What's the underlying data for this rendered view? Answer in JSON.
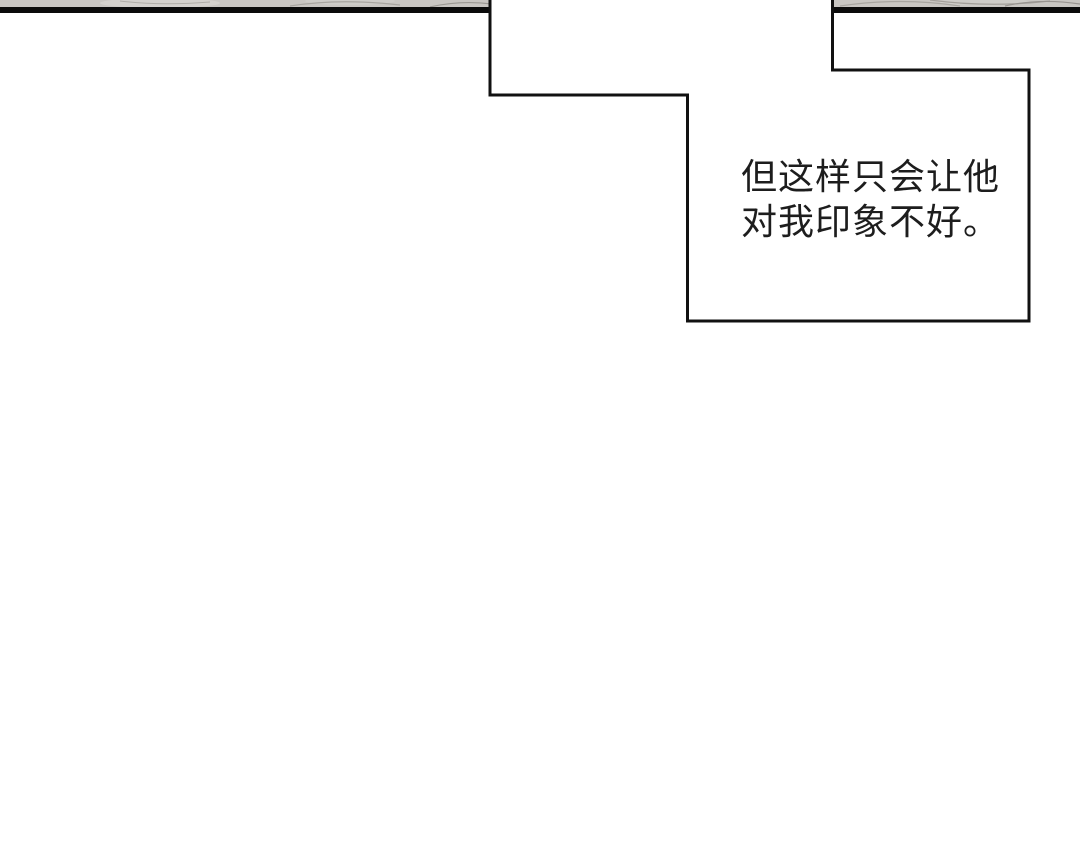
{
  "page": {
    "background_color": "#ffffff"
  },
  "top_panel": {
    "fill_color": "#c9c6c2",
    "border_color": "#0b0b0b"
  },
  "speech_bubble": {
    "fill_color": "#ffffff",
    "border_color": "#111111",
    "text_color": "#1d1d1d",
    "lines": [
      "但这样只会让他",
      "对我印象不好。"
    ],
    "full_text": "但这样只会让他对我印象不好。"
  }
}
